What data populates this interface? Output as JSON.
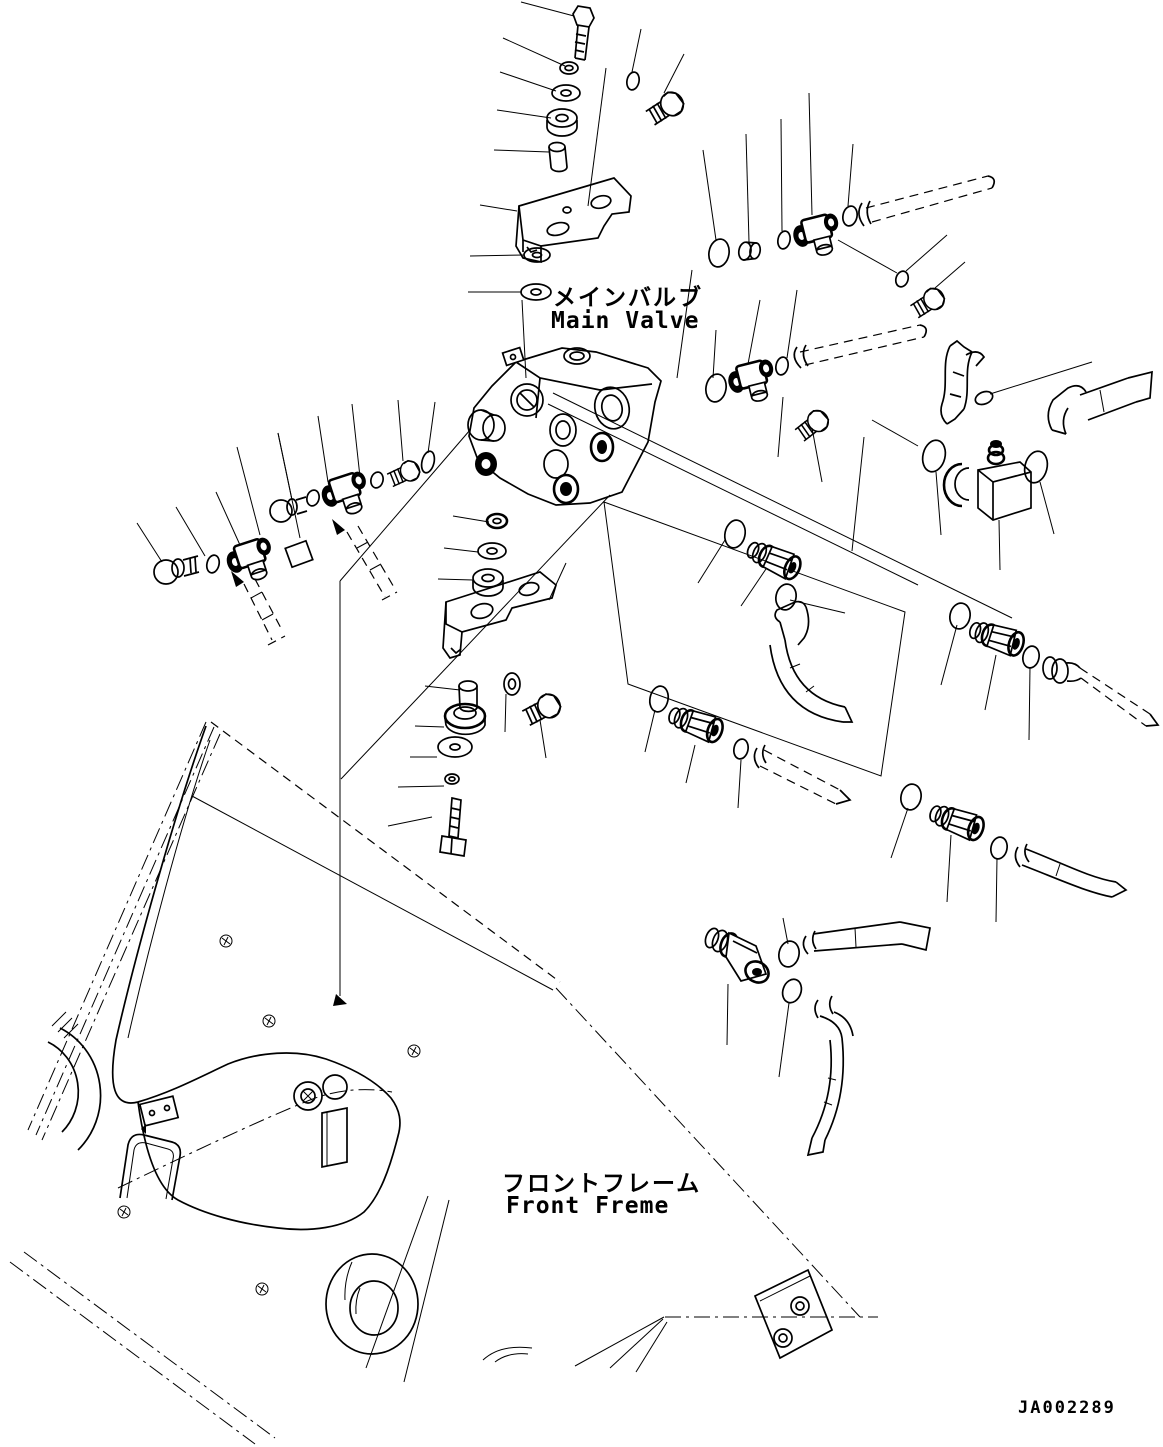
{
  "page": {
    "background": "#ffffff",
    "line_color": "#000000",
    "type": "exploded-parts-diagram"
  },
  "labels": {
    "main_valve": {
      "ja": "メインバルブ",
      "en": "Main Valve"
    },
    "front_frame": {
      "ja": "フロントフレーム",
      "en": "Front Freme"
    },
    "drawing_number": "JA002289"
  },
  "components": [
    "hex-bolt",
    "spring-washer",
    "plain-washer",
    "spacer-collar",
    "mounting-bracket",
    "main-control-valve",
    "tee-fitting",
    "o-ring",
    "hex-plug",
    "elbow-fitting",
    "hose-connector",
    "hydraulic-hose",
    "front-frame",
    "wheel-arch",
    "mounting-plate"
  ]
}
